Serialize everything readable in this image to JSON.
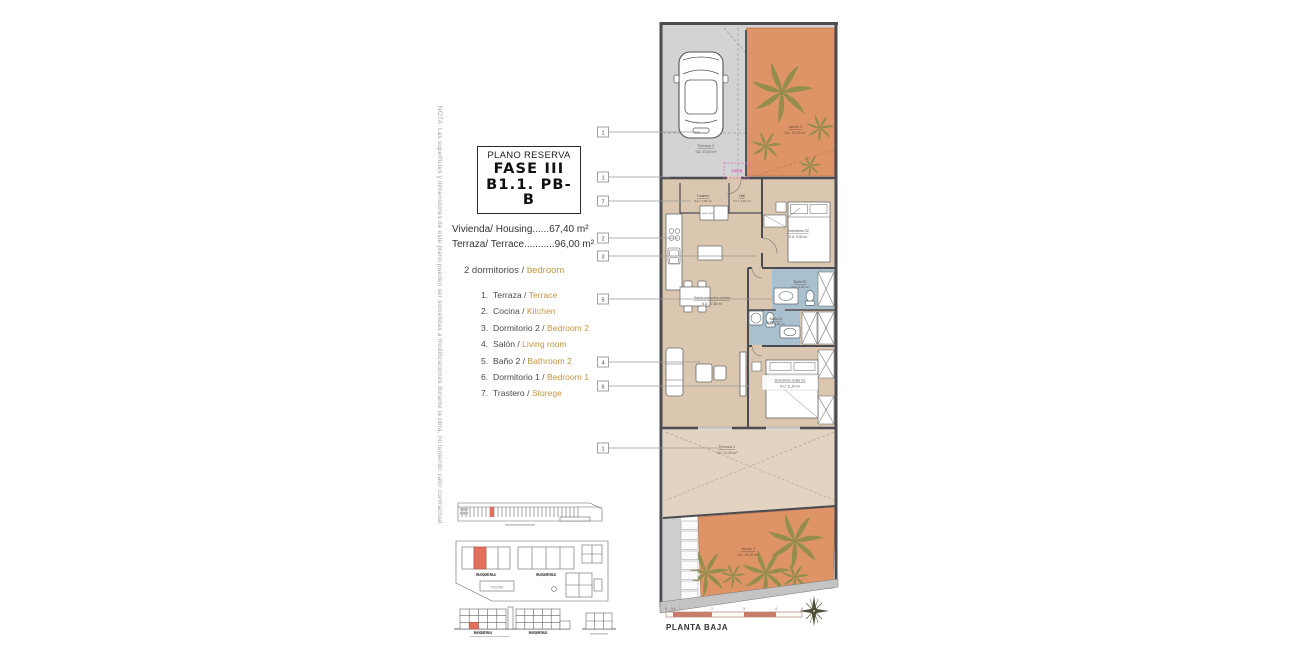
{
  "note": {
    "text": "NOTA: Las superficies y dimensiones de este plano pueden ser sometidas a modificaciones durante la obra, no teniendo valor contractual."
  },
  "title_box": {
    "line1": "PLANO RESERVA",
    "line2": "FASE III",
    "line3": "B1.1. PB-B"
  },
  "areas": {
    "housing": "Vivienda/ Housing......67,40 m²",
    "terrace": "Terraza/ Terrace...........96,00 m²"
  },
  "legend": {
    "header_es": "2 dormitorios / ",
    "header_en": "bedroom",
    "items": [
      {
        "num": "1.",
        "es": "Terraza / ",
        "en": "Terrace"
      },
      {
        "num": "2.",
        "es": "Cocina / ",
        "en": "Kitchen"
      },
      {
        "num": "3.",
        "es": "Dormitorio 2 / ",
        "en": "Bedroom 2"
      },
      {
        "num": "4.",
        "es": "Salón / ",
        "en": "Living room"
      },
      {
        "num": "5.",
        "es": "Baño 2 / ",
        "en": "Bathroom 2"
      },
      {
        "num": "6.",
        "es": "Dormitorio 1 / ",
        "en": "Bedroom 1"
      },
      {
        "num": "7.",
        "es": "Trastero / ",
        "en": "Storege"
      }
    ]
  },
  "plan": {
    "unit_tag": "PB-B",
    "appliance": "LAVADORA",
    "markers": [
      "1",
      "1",
      "7",
      "2",
      "3",
      "5",
      "4",
      "6",
      "1"
    ],
    "rooms": {
      "terraza2": {
        "name": "Terraza 2",
        "area": "SU: 23,00 m²"
      },
      "jardin2": {
        "name": "Jardín 2",
        "area": "SU: 20,00 m²"
      },
      "trastero": {
        "name": "Trastero",
        "area": "S.U: 1,90 m²"
      },
      "hall": {
        "name": "Hall",
        "area": "S.U: 1,15 m²"
      },
      "dormitorio2": {
        "name": "Dormitorio 02",
        "area": "S.U: 9,30 m²"
      },
      "salon": {
        "name": "Salón-comedor-cocina",
        "area": "S.U: 27,80 m²"
      },
      "bano2": {
        "name": "Baño 02",
        "area": "S.U: 4,20 m²"
      },
      "bano1": {
        "name": "Baño 01",
        "area": "S.U: 3,80 m²"
      },
      "suite": {
        "name": "Dormitorio Suite 01",
        "area": "S.U: 11,20 m²"
      },
      "terraza1": {
        "name": "Terraza 1",
        "area": "SU: 31,00 m²"
      },
      "jardin1": {
        "name": "Jardín 1",
        "area": "SU: 19,00 m²"
      }
    },
    "scale": {
      "t0": "0",
      "t05": "0,5",
      "t1": "1",
      "t2": "2",
      "t3": "3",
      "t4": "4",
      "t5": "5",
      "caption": "PLANTA BAJA"
    }
  },
  "siteplan": {
    "block1": "BLOQUE B1.1",
    "block2": "BLOQUE B1.2",
    "pool": "PISCINA"
  },
  "colors": {
    "garden_orange": "#df9468",
    "legend_orange": "#c49544",
    "bath_blue": "#a9c0ce",
    "floor_beige": "#dbc6af",
    "terrace_beige": "#e3d4c2",
    "paving_gray": "#d3d3d3",
    "wall_dark": "#4b4b52",
    "entry_pink": "#e060c4",
    "highlight_red": "#e2705c",
    "scale_red": "#c87c6e"
  }
}
